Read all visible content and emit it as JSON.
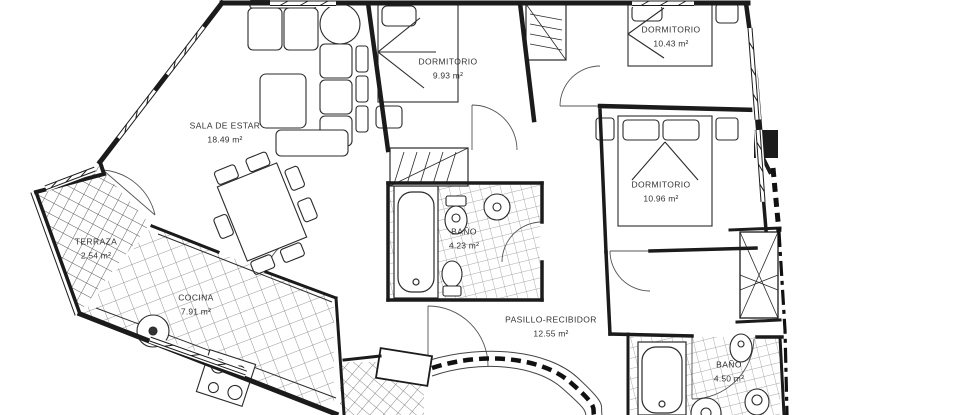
{
  "drawing": {
    "kind": "architectural floor plan"
  },
  "rooms": [
    {
      "id": "sala-de-estar",
      "name": "SALA DE ESTAR",
      "area": "18.49 m²"
    },
    {
      "id": "dormitorio-1",
      "name": "DORMITORIO",
      "area": "9.93 m²"
    },
    {
      "id": "dormitorio-2",
      "name": "DORMITORIO",
      "area": "10.43 m²"
    },
    {
      "id": "dormitorio-3",
      "name": "DORMITORIO",
      "area": "10.96 m²"
    },
    {
      "id": "bano-1",
      "name": "BAÑO",
      "area": "4.23 m²"
    },
    {
      "id": "cocina",
      "name": "COCINA",
      "area": "7.91 m²"
    },
    {
      "id": "terraza",
      "name": "TERRAZA",
      "area": "2.54 m²"
    },
    {
      "id": "pasillo-recibidor",
      "name": "PASILLO-RECIBIDOR",
      "area": "12.55 m²"
    },
    {
      "id": "bano-2",
      "name": "BAÑO",
      "area": "4.50 m²"
    }
  ],
  "colors": {
    "ink": "#1b1b1b",
    "paper": "#ffffff",
    "label": "#333333",
    "tile": "#8a8a8a"
  }
}
